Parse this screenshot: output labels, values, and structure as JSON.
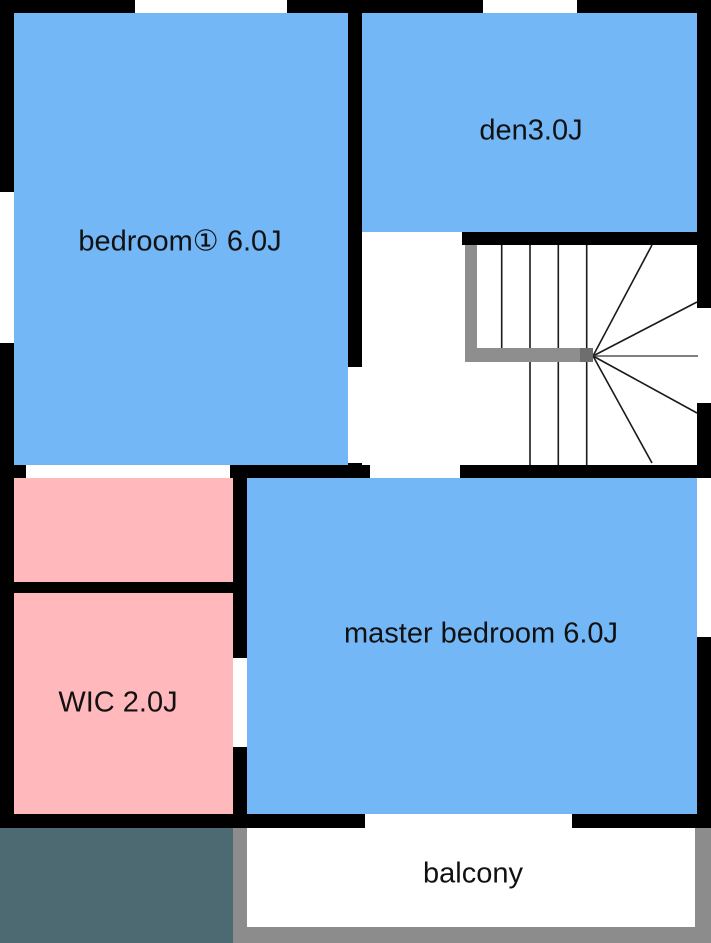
{
  "floor_plan": {
    "title": "second floor plan",
    "rooms": [
      {
        "name": "bedroom-1",
        "label": "bedroom① 6.0J"
      },
      {
        "name": "den",
        "label": "den3.0J"
      },
      {
        "name": "master-bedroom",
        "label": "master bedroom 6.0J"
      },
      {
        "name": "closet",
        "label": ""
      },
      {
        "name": "wic",
        "label": "WIC 2.0J"
      },
      {
        "name": "balcony",
        "label": "balcony"
      }
    ],
    "colors": {
      "room_blue": "#73b7f7",
      "room_pink": "#ffb9bd",
      "wall_black": "#000000",
      "roof_slate": "#4d6972",
      "balcony_gray": "#8c8c8c",
      "handrail_gray": "#8e8e8e",
      "handrail_post": "#6e6e6e",
      "stair_line": "#1a1a1a",
      "floor_white": "#ffffff"
    }
  }
}
